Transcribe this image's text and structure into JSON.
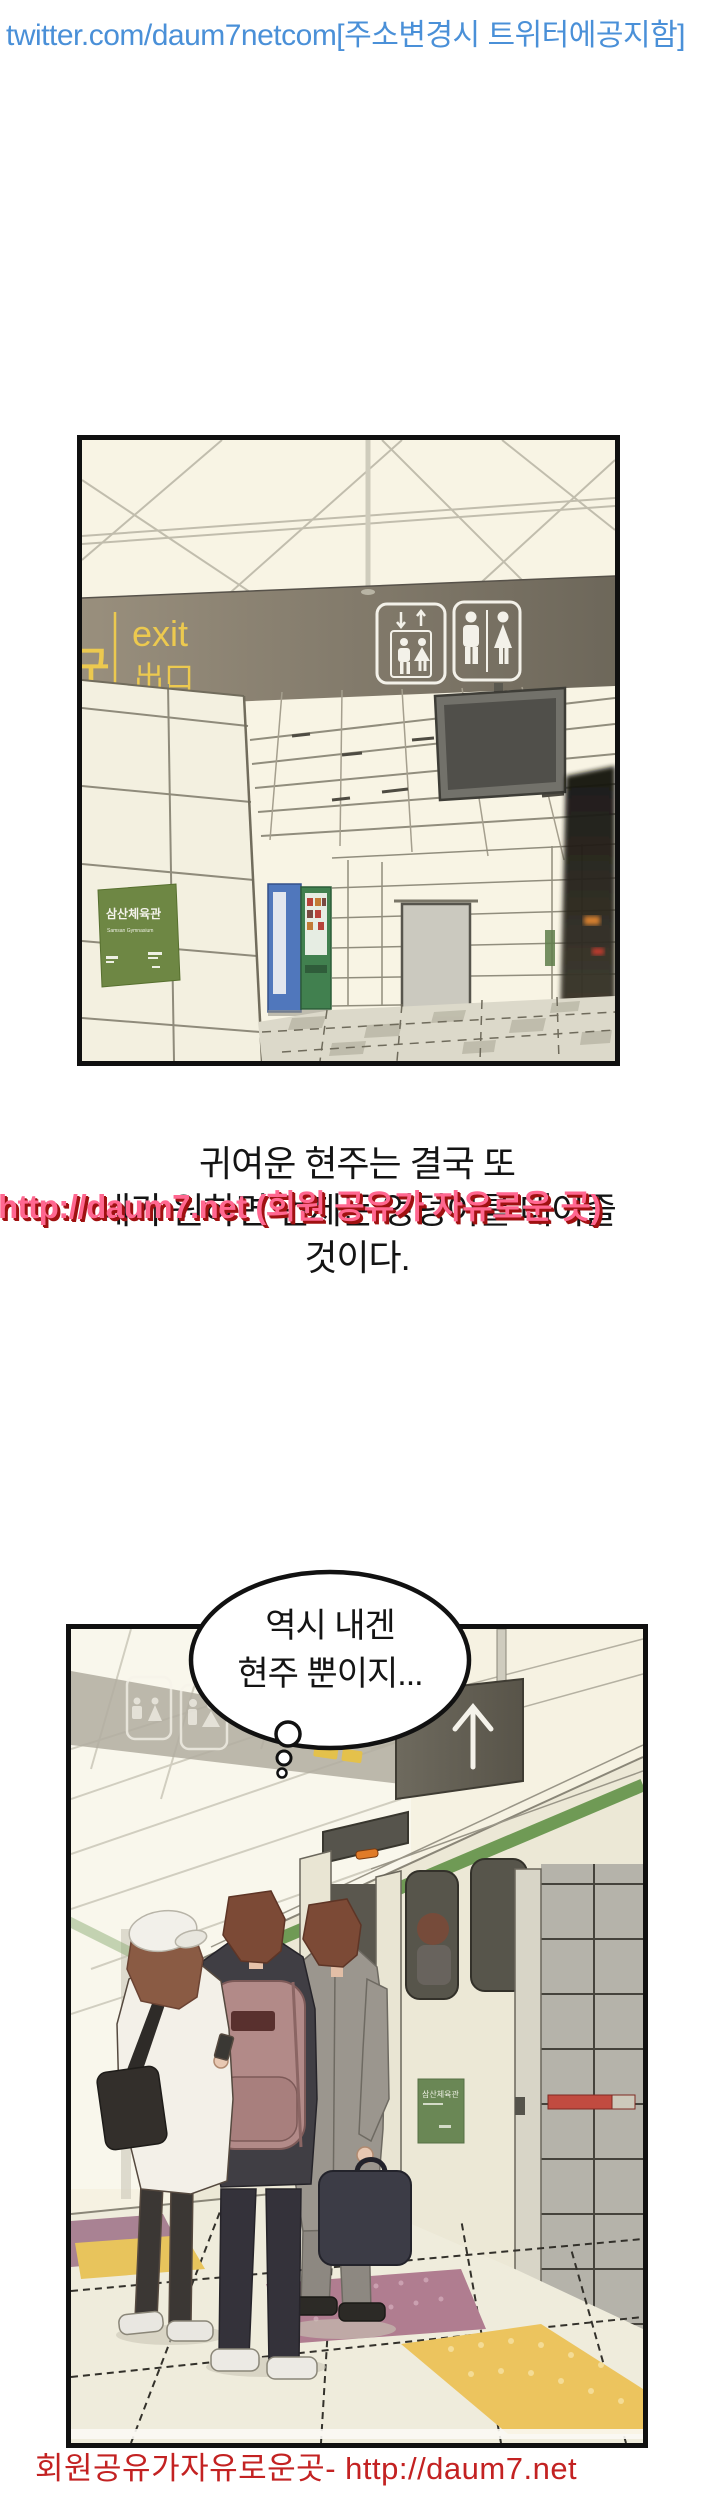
{
  "header": {
    "text": "twitter.com/daum7netcom[주소변경시 트위터에공지함]"
  },
  "panel1": {
    "exit_sign": {
      "korean": "출구",
      "english": "exit",
      "chinese": "出口"
    },
    "station_sign": {
      "title": "삼산체육관",
      "subtitle": "Samsan Gymnasium"
    }
  },
  "narration": {
    "line1": "귀여운 현주는 결국 또",
    "line2": "내가 원하면 언제든 엉덩이를 대어줄",
    "line3": "것이다."
  },
  "watermark": {
    "text": "http://daum7.net (회원 공유가 자유로운 곳)"
  },
  "panel2": {
    "speech_bubble": {
      "line1": "역시 내겐",
      "line2": "현주 뿐이지..."
    },
    "glass_sign": {
      "title": "삼산체육관"
    }
  },
  "footer": {
    "text": "회원공유가자유로운곳- http://daum7.net"
  },
  "colors": {
    "header_blue": "#4a90d8",
    "watermark_pink": "#ff6790",
    "watermark_shadow": "#a01111",
    "footer_red": "#c32222",
    "panel_border": "#101010",
    "sign_yellow": "#ecc94f",
    "band_olive": "#7d766a",
    "train_green": "#6f9a55",
    "station_sign_green": "#6e8744"
  }
}
